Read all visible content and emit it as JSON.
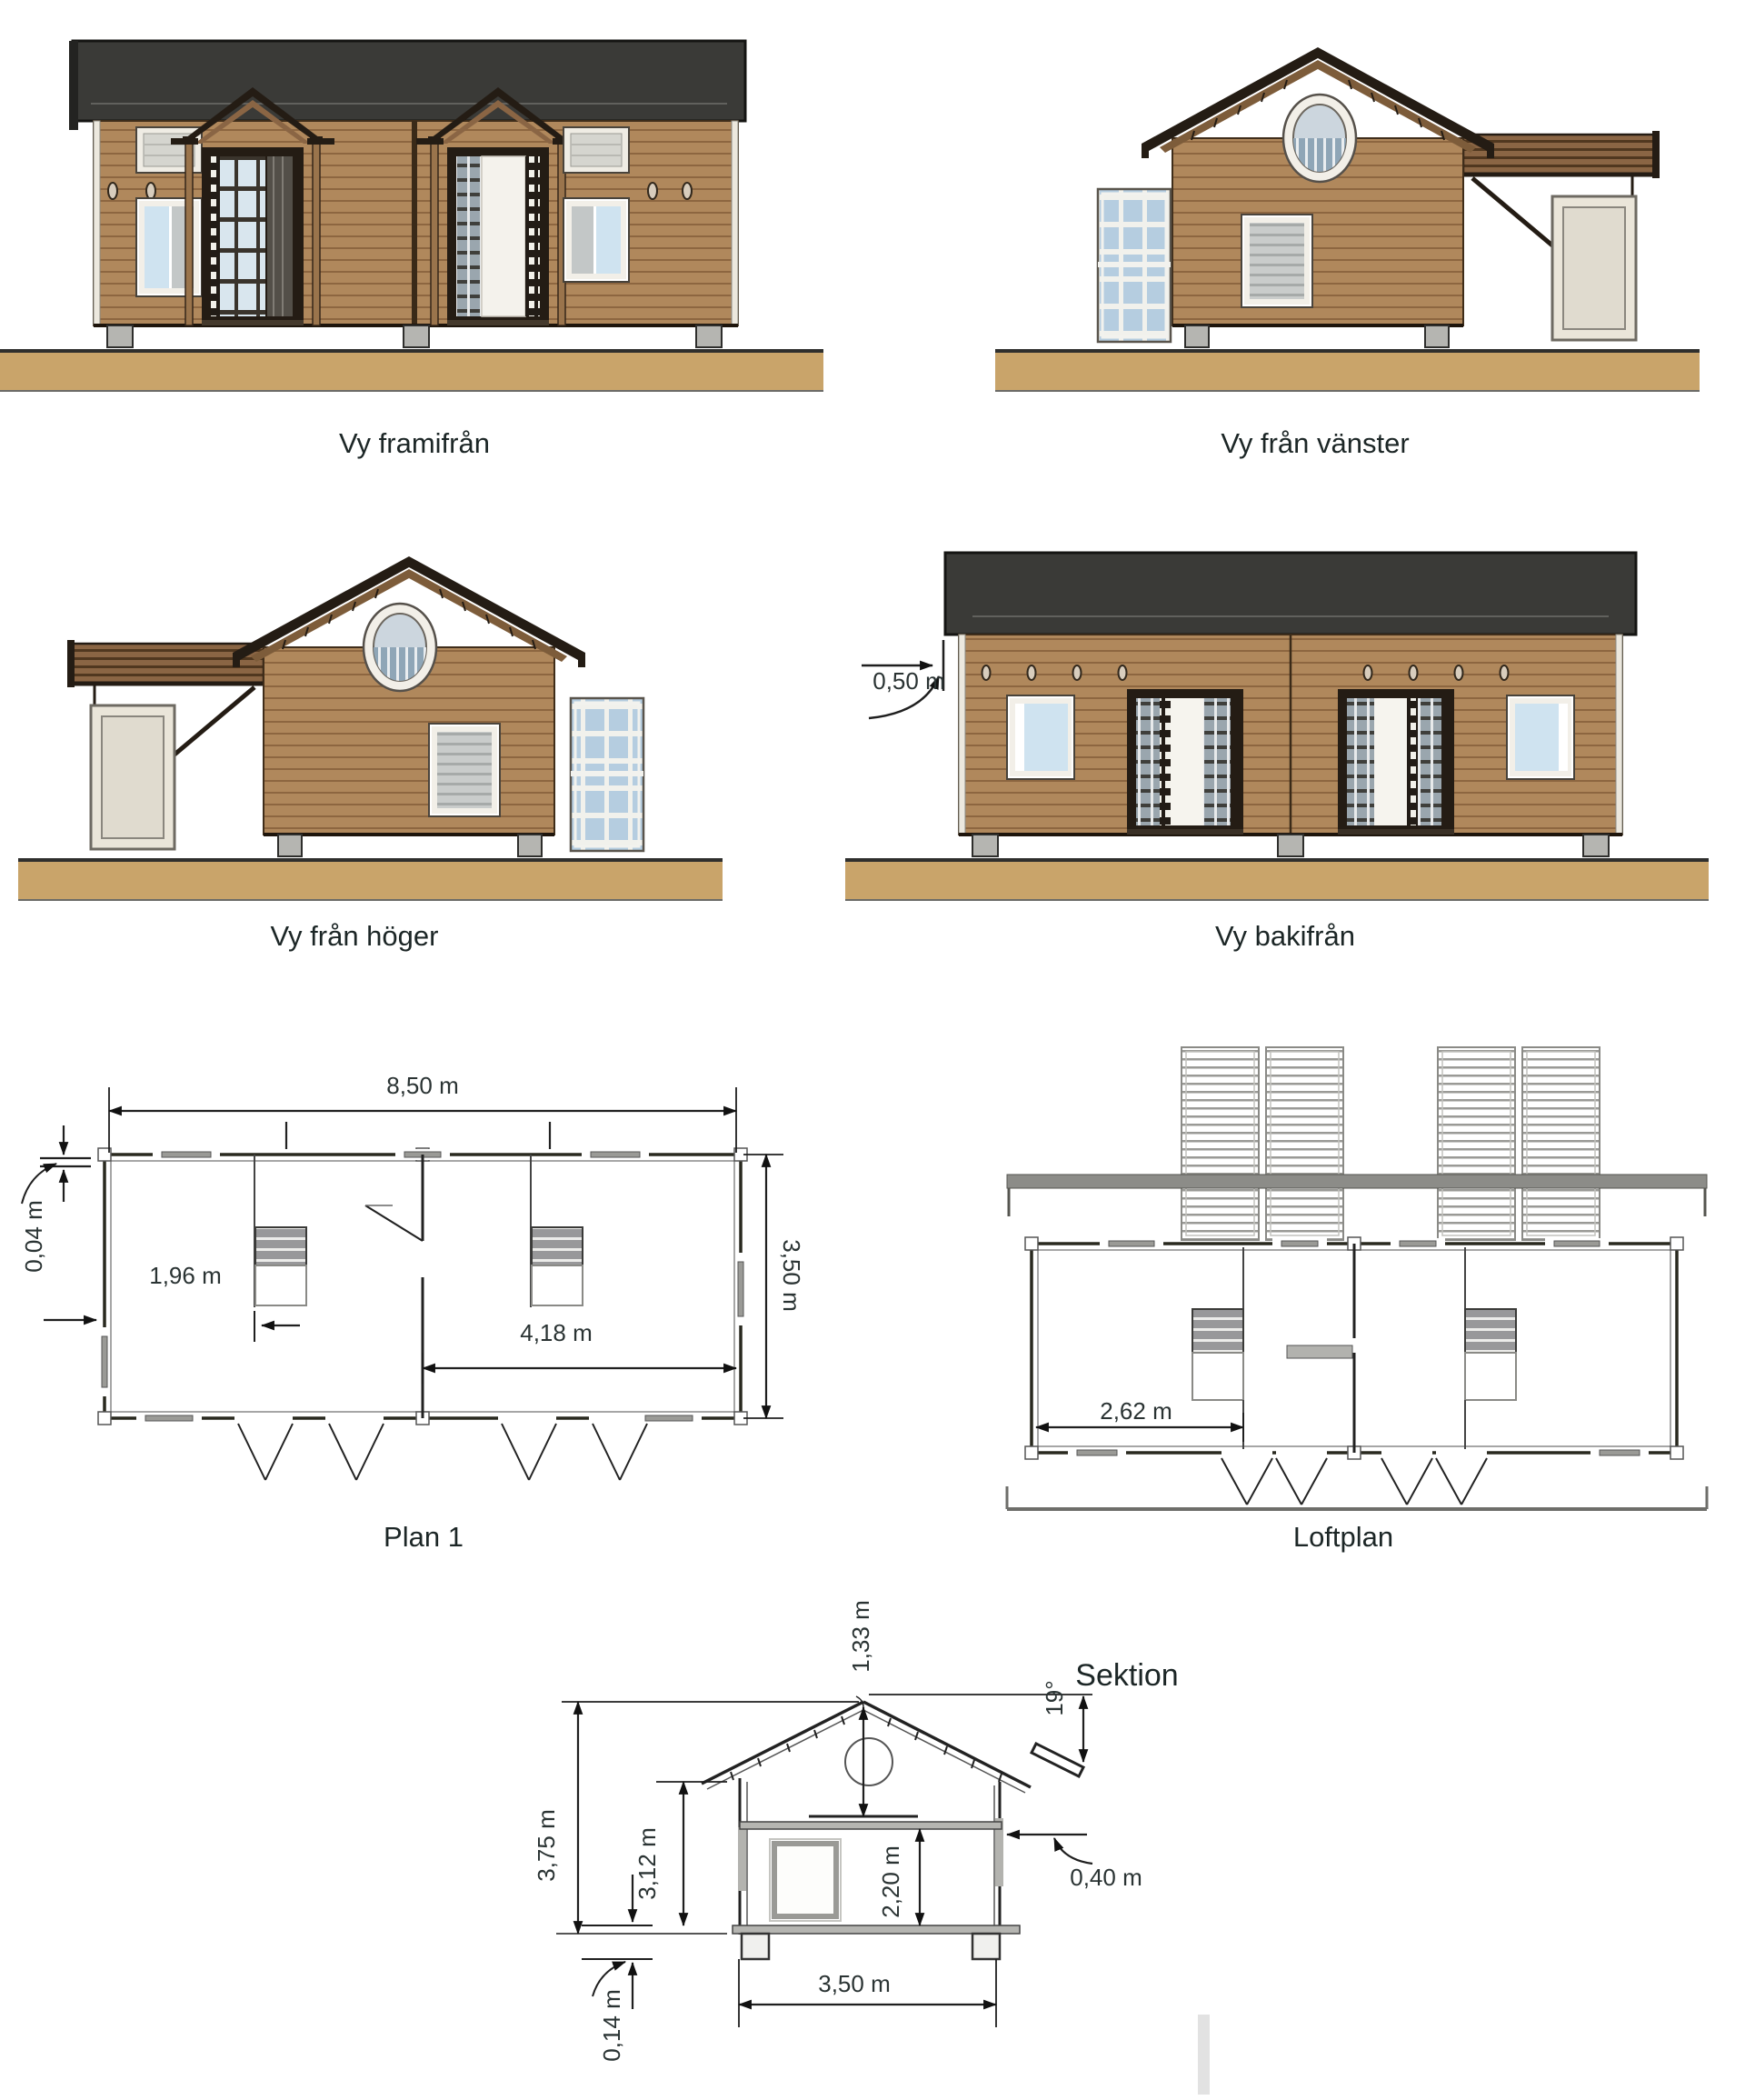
{
  "drawing": {
    "views": {
      "front": {
        "label": "Vy framifrån"
      },
      "left": {
        "label": "Vy från vänster"
      },
      "right": {
        "label": "Vy från höger"
      },
      "back": {
        "label": "Vy bakifrån",
        "dims": {
          "roof_overhang": "0,50 m"
        }
      },
      "plan1": {
        "label": "Plan 1",
        "dims": {
          "total_width": "8,50 m",
          "wall_offset": "0,04 m",
          "left_section": "1,96 m",
          "right_section": "4,18 m",
          "depth": "3,50 m"
        }
      },
      "loft": {
        "label": "Loftplan",
        "dims": {
          "loft_width": "2,62 m"
        }
      },
      "section": {
        "label": "Sektion",
        "dims": {
          "ridge_to_loft": "1,33 m",
          "roof_angle": "19°",
          "eave_overhang": "0,40 m",
          "total_height": "3,75 m",
          "eave_height": "3,12 m",
          "interior_height": "2,20 m",
          "width": "3,50 m",
          "base_thickness": "0,14 m"
        }
      }
    },
    "colors": {
      "roof": "#3a3a37",
      "siding": "#b0885c",
      "ground": "#c9a46a",
      "glass": "#cfe3f0",
      "line": "#1f1f1f"
    }
  }
}
